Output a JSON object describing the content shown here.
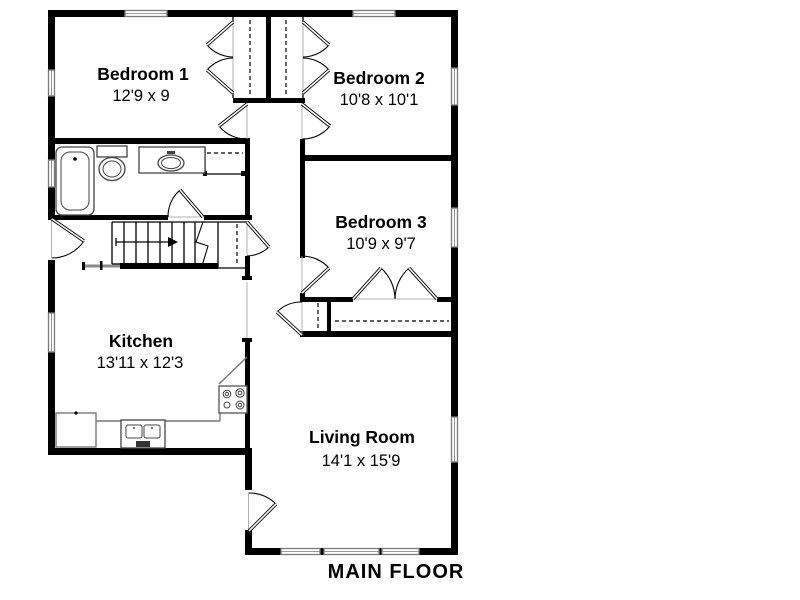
{
  "plan": {
    "title": "MAIN FLOOR",
    "rooms": {
      "bedroom1": {
        "name": "Bedroom 1",
        "dims": "12'9 x 9"
      },
      "bedroom2": {
        "name": "Bedroom 2",
        "dims": "10'8 x 10'1"
      },
      "bedroom3": {
        "name": "Bedroom 3",
        "dims": "10'9 x 9'7"
      },
      "kitchen": {
        "name": "Kitchen",
        "dims": "13'11 x 12'3"
      },
      "living": {
        "name": "Living Room",
        "dims": "14'1 x 15'9"
      }
    },
    "colors": {
      "wall": "#000000",
      "window_frame": "#7a7a7a",
      "fixture": "#444444",
      "counter": "#777777",
      "railing": "#8a8a8a",
      "text": "#000000",
      "background": "#ffffff"
    }
  }
}
